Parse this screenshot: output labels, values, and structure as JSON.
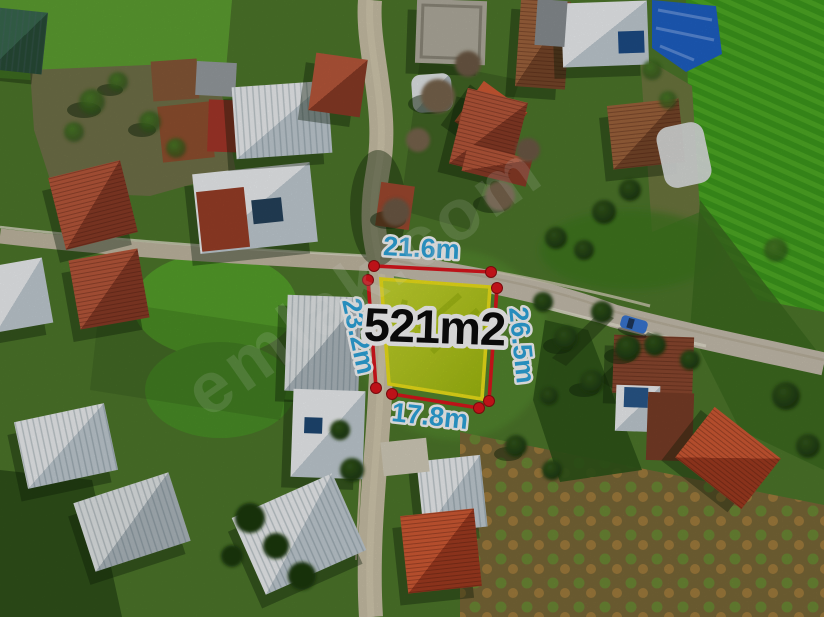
{
  "annotation": {
    "area_label": "521m2",
    "measurements": {
      "top": "21.6m",
      "left": "23.2m",
      "right": "26.5m",
      "bottom": "17.8m"
    },
    "colors": {
      "measurement_text": "#2fa9e1",
      "measurement_line": "#e2161d",
      "corner_dot": "#e2161d",
      "parcel_outline": "#f4e81a",
      "parcel_fill": "#b7cc1f",
      "area_text": "#0d0d0d",
      "label_outline": "#ffffff"
    }
  },
  "watermark": {
    "text": "emlak.com"
  }
}
